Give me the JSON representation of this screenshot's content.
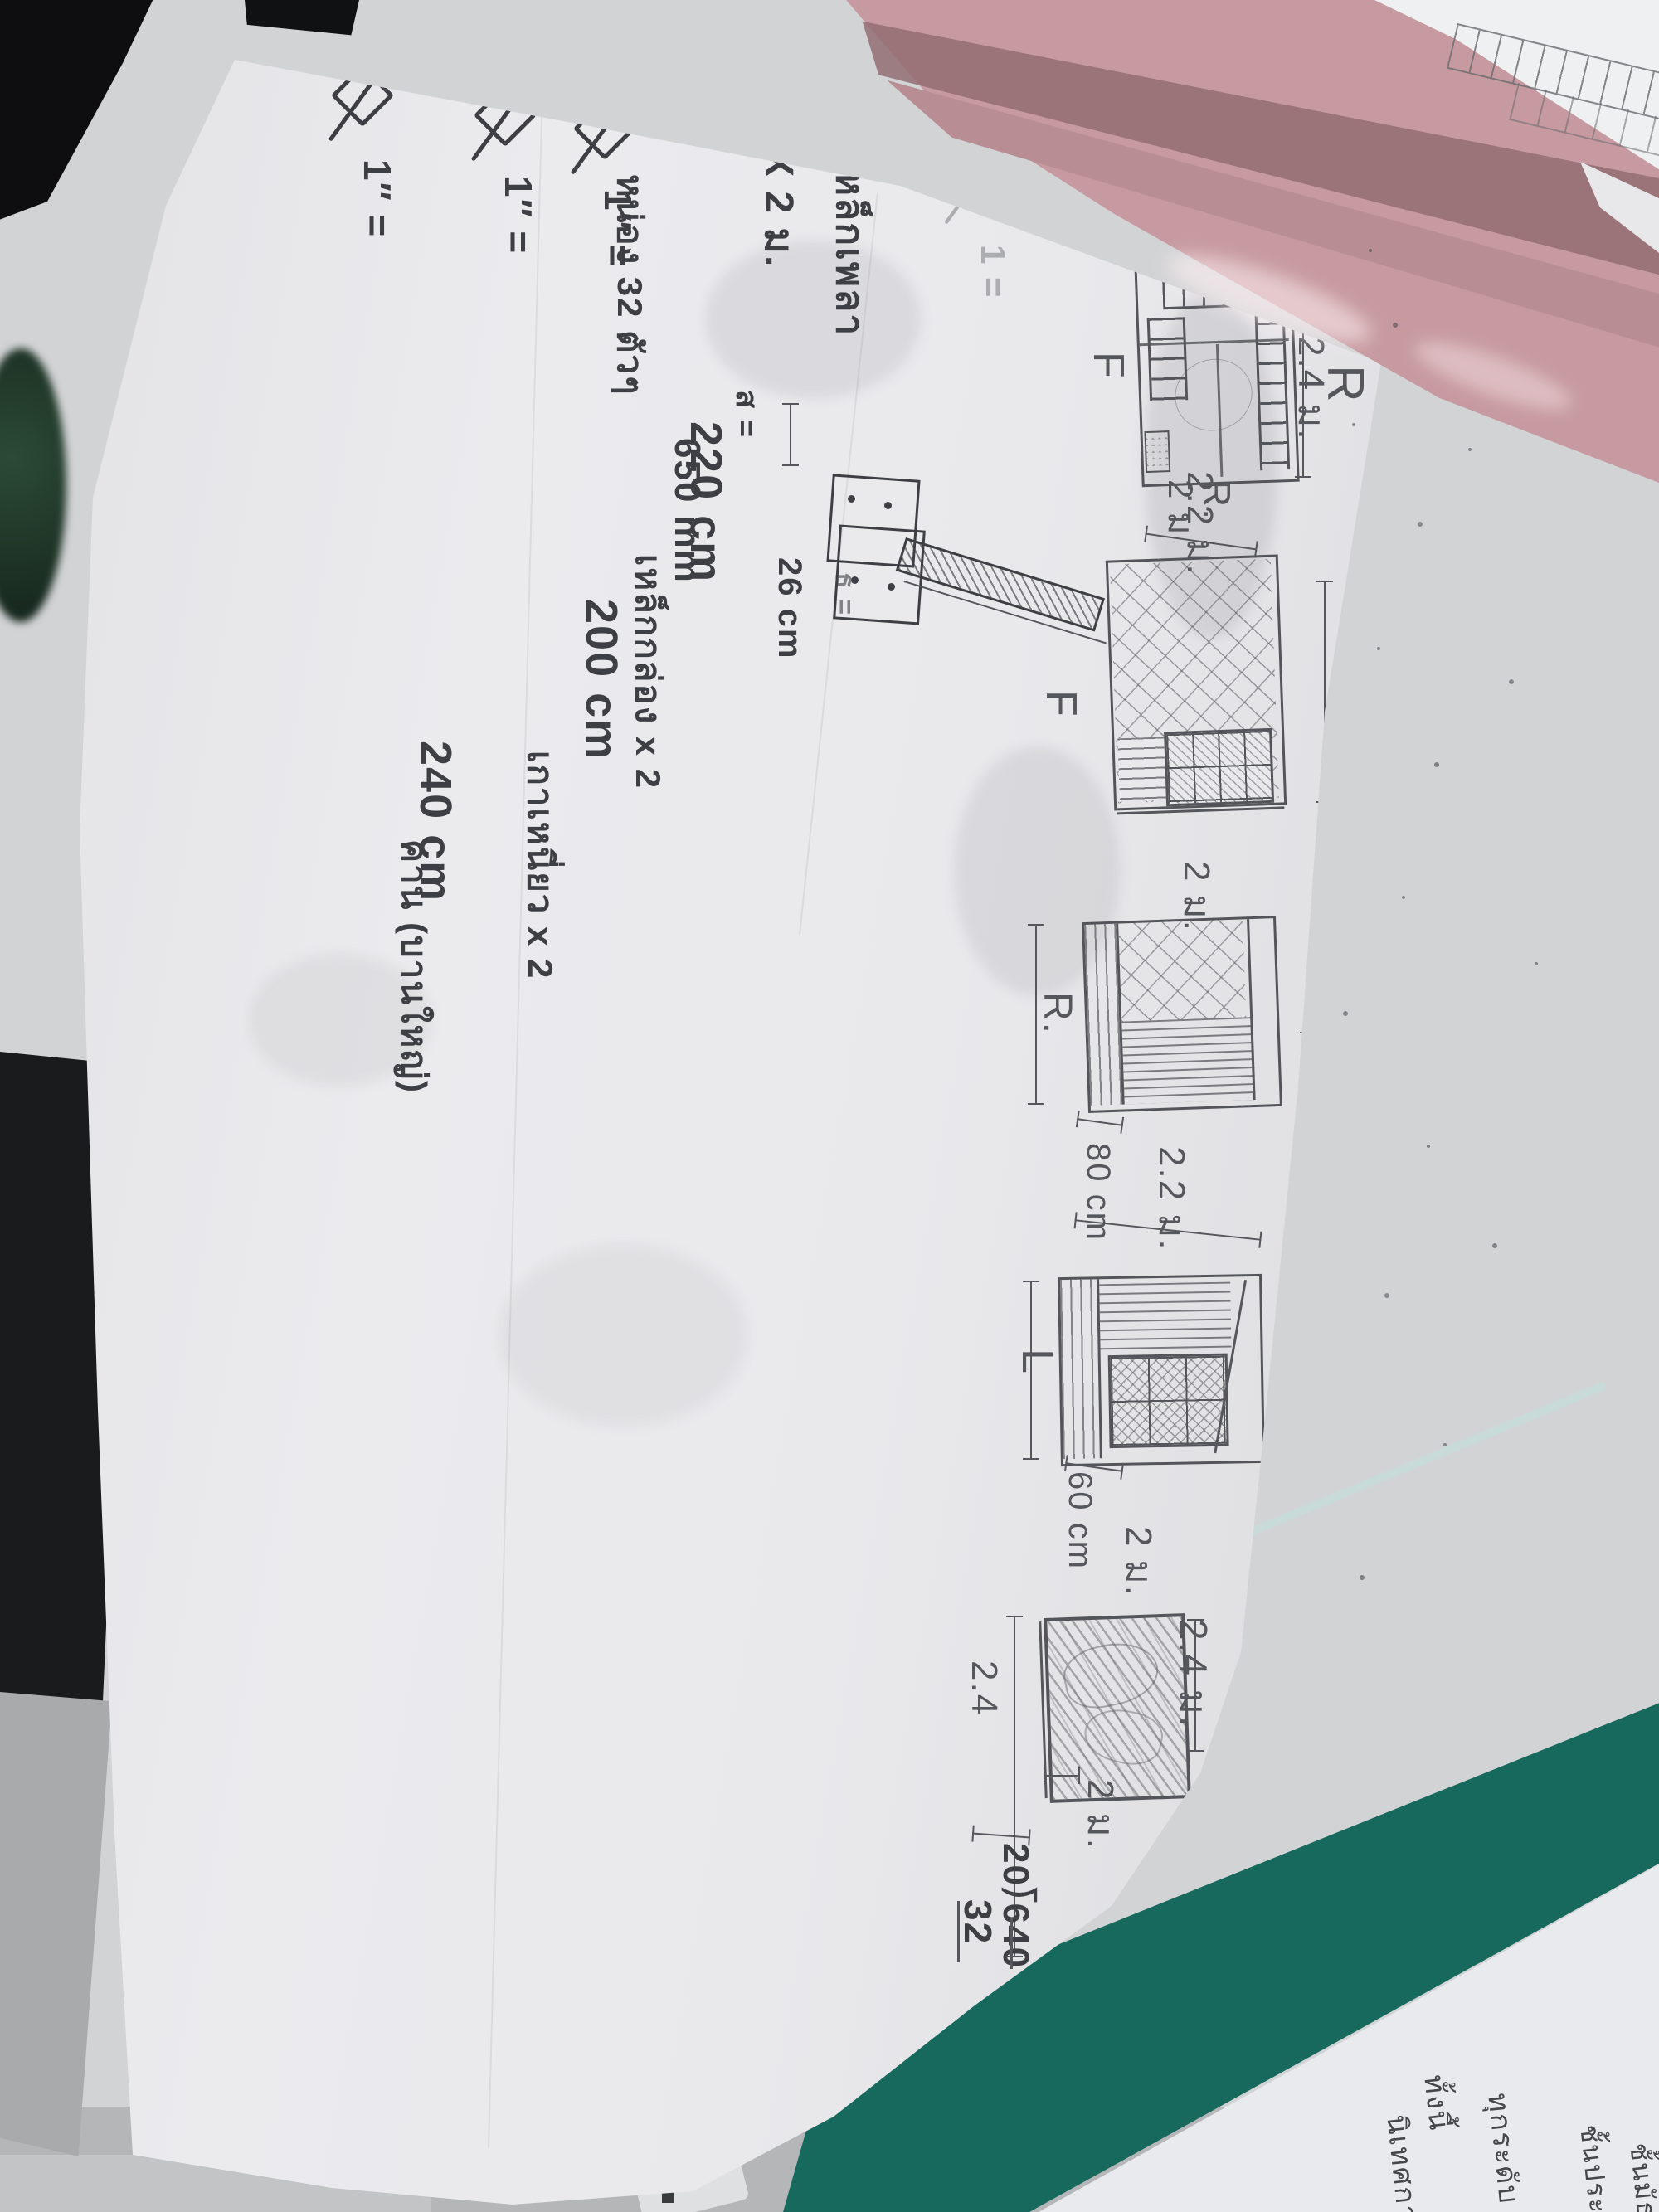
{
  "notes": {
    "title1": "เหล็กเพลา",
    "title2": "2″ X 2 ม.",
    "qty": "หน่อง 32 ตัวๆ",
    "len": "650 mm",
    "det_label": "ส =",
    "det_label2": "ธ =",
    "det_dim": "26 cm",
    "faint": "1 =",
    "rows": [
      {
        "size": "1″",
        "eq": "=",
        "value": "220 cm",
        "desc": "เหล็กกล่อง x 2"
      },
      {
        "size": "1″",
        "eq": "=",
        "value": "200 cm",
        "desc": "เกาเหนี่ยว x 2"
      },
      {
        "size": "1″",
        "eq": "=",
        "value": "240 cm",
        "desc": "คาน (บานใหญ่)"
      }
    ]
  },
  "panels": {
    "p1": {
      "name_top": "L",
      "dim_top": "2 ม.",
      "side_label": "F",
      "name_right": "R",
      "dim_right": "2.4 ม.",
      "dim_bottom": "2 ม",
      "name_bottom": "R."
    },
    "p2": {
      "dim_top": "2.2 ม.",
      "side_label": "F",
      "dim_right": "2.4 ม.",
      "dim_bottom": "2 ม."
    },
    "p3": {
      "name_left": "R.",
      "dim_right": "1 ม.",
      "dim_below_a": "80 cm",
      "dim_below_b": "2.2 ม."
    },
    "p4": {
      "name_left": "L",
      "dim_right_a": "1 ม.",
      "dim_right_b": "1 ม.",
      "dim_below_a": "60 cm",
      "dim_below_b": "2 ม."
    },
    "p5": {
      "dim_right": "2.4 ม.",
      "dim_left": "2.4",
      "dim_bottom": "2 ม.",
      "calc_div": "20⟌640",
      "calc_res": "32"
    }
  },
  "corner_paper": {
    "lines": [
      "ทั้งนี้",
      "ทุกระดับ",
      "นิเทศการสอน",
      "ชั้นประถม",
      "ชั้นมัธยม"
    ]
  },
  "colors": {
    "paper": "#e9e9ec",
    "pencil": "#56575c",
    "pen": "#3e3f44",
    "pink_folder": "#c69aa0",
    "pink_dark": "#936d73",
    "teal_folder": "#17695d",
    "desk": "#b5b6b8",
    "background": "#d2d3d5",
    "black_object": "#0e0e10",
    "green_object": "#23402d",
    "corner_paper": "#e9eaed"
  }
}
